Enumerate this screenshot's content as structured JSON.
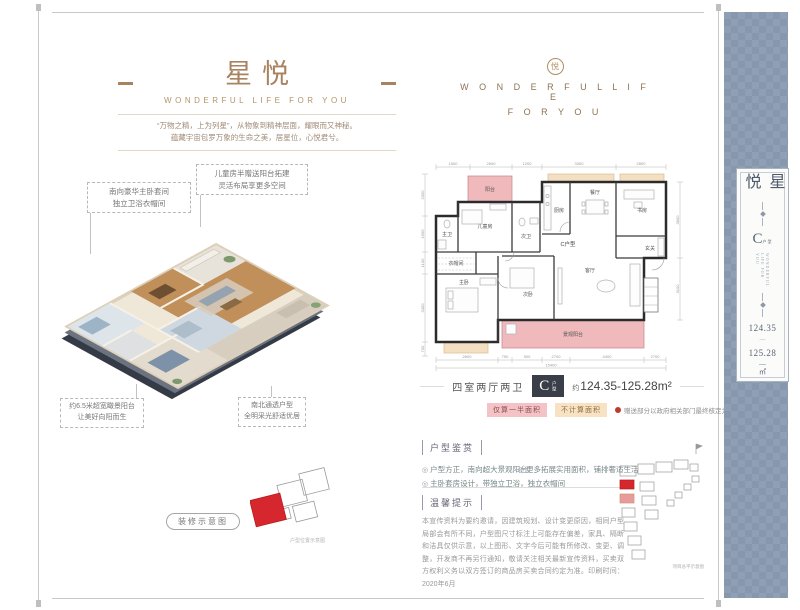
{
  "colors": {
    "accent_bronze": "#a9825f",
    "balcony_pink": "#f0b9bc",
    "not_counted_beige": "#f5dfc2",
    "badge_bg": "#3a3e48",
    "sidebar_blue": "#8fa0b6",
    "highlight_red": "#c9302f"
  },
  "header_left": {
    "title": "星悦",
    "subtitle": "WONDERFUL LIFE FOR YOU",
    "tagline_line1": "“万物之精，上为列星”，从物象到精神层面，耀眼而又神秘。",
    "tagline_line2": "蕴藏宇宙包罗万象的生命之美，居星位，心悦君兮。"
  },
  "header_right": {
    "logo_char": "悦",
    "line1": "W O N D E R F U L   L I F E",
    "line2": "F O R   Y O U"
  },
  "callouts": {
    "master": {
      "line1": "南向豪华主卧套间",
      "line2": "独立卫浴衣帽间"
    },
    "children": {
      "line1": "儿童房半赠送阳台拓建",
      "line2": "灵活布局享更多空间"
    },
    "balcony": {
      "line1": "约6.5米超宽瞰景阳台",
      "line2": "让美好向阳而生"
    },
    "northsouth": {
      "line1": "南北通透户型",
      "line2": "全明采光舒适优居"
    }
  },
  "render_caption": "装修示意图",
  "unit_location_caption": "户型位置示意图",
  "floorplan": {
    "unit_label": "C户型",
    "rooms": [
      {
        "label": "阳台"
      },
      {
        "label": "儿童房"
      },
      {
        "label": "主卫"
      },
      {
        "label": "次卫"
      },
      {
        "label": "厨房"
      },
      {
        "label": "餐厅"
      },
      {
        "label": "书房"
      },
      {
        "label": "玄关"
      },
      {
        "label": "衣帽间"
      },
      {
        "label": "主卧"
      },
      {
        "label": "次卧"
      },
      {
        "label": "客厅"
      },
      {
        "label": "景观阳台"
      }
    ],
    "dims_top": [
      "1500",
      "2600",
      "1200",
      "3300",
      "2800"
    ],
    "dims_bottom": [
      "2600",
      "750",
      "900",
      "2700",
      "4400",
      "2700"
    ],
    "dims_total": "15400",
    "dims_left": [
      "2000",
      "1600",
      "1100",
      "3400",
      "700"
    ],
    "dims_right": [
      "3800",
      "3100"
    ]
  },
  "spec": {
    "layout": "四室两厅两卫",
    "badge_letter": "C",
    "badge_sub": "户型",
    "area_prefix": "约",
    "area": "124.35-125.28m²",
    "legend_half": "仅算一半面积",
    "legend_none": "不计算面积",
    "legend_note": "赠送部分以政府相关部门最终核定为准"
  },
  "appreciation": {
    "title": "户型鉴赏",
    "bullet": "◎",
    "items": [
      "户型方正，南向超大景观阳台",
      "更多拓展实用面积，铺排奢适生活",
      "主卧套房设计，带独立卫浴，独立衣帽间"
    ]
  },
  "notice": {
    "title": "温馨提示",
    "body": "本宣传资料为要约邀请，因建筑规划、设计变更原因，相同户型局部会有所不同，户型图尺寸标注上可能存在偏差，家具、隔断和洁具仅供示意，以上图形、文字今后可能有所修改、变更、调整，开发商不再另行通知，敬请关注相关最新宣传资料，买卖双方权利义务以双方签订的商品房买卖合同约定为准。印刷时间：2020年6月"
  },
  "siteplan_caption": "项目总平示意图",
  "sidebar": {
    "title": "星悦",
    "unit_letter": "C",
    "unit_sub": "户型",
    "vertical_eng": "WONDERFUL LIFE FOR YOU",
    "area1": "124.35",
    "dash": "—",
    "area2": "125.28",
    "unit_area": "㎡"
  }
}
